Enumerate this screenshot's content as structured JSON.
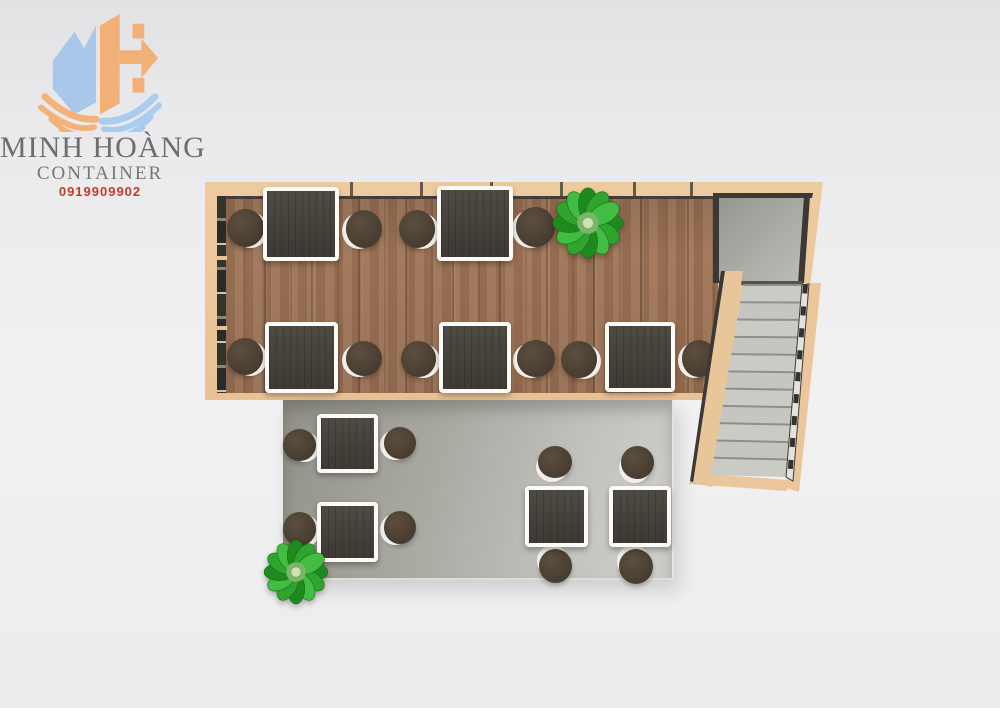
{
  "brand": {
    "name": "MINH HOÀNG",
    "subtitle": "CONTAINER",
    "phone": "0919909902",
    "colors": {
      "m_blue": "#a9c7e8",
      "h_orange": "#f2b077",
      "wing_orange": "#f3b277",
      "wing_blue": "#a9cdec",
      "text_gray": "#6e6e6e",
      "phone_red": "#c23a2c"
    }
  },
  "scene": {
    "description": "Top-down 3D floor plan of a container cafe: upper wood-floor container room with tables and stools, exterior concrete deck with tables, side staircase with landing, two green plants",
    "upper_room": {
      "floor": "wood",
      "tables": 5,
      "stools": 10,
      "plants": 1
    },
    "lower_deck": {
      "floor": "concrete",
      "tables": 4,
      "stools": 8,
      "plants": 1
    },
    "staircase": {
      "steps": 11,
      "has_landing": true
    }
  },
  "palette": {
    "wall_tan": "#ebc69b",
    "wood": "#9e7355",
    "frame_dark": "#3b3835",
    "landing_a": "#94978f",
    "landing_b": "#bcbfb7",
    "step": "#cbcbc6",
    "step_line": "#8f8f8a",
    "deck": "#a9a9a2",
    "table_top": "#45403a",
    "table_border": "#fbfaf7",
    "stool": "#4a3f32",
    "plant_greens": [
      "#1e8a1e",
      "#2fa42f",
      "#43bc43"
    ],
    "plant_center": "#7ab569"
  },
  "layout": {
    "wall_ticks_x": [
      350,
      420,
      490,
      560,
      633,
      690
    ],
    "wall_breaks_y": [
      256,
      326
    ],
    "tables": [
      [
        263,
        187,
        76,
        74
      ],
      [
        437,
        186,
        76,
        75
      ],
      [
        265,
        322,
        73,
        71
      ],
      [
        439,
        322,
        72,
        71
      ],
      [
        605,
        322,
        70,
        70
      ],
      [
        317,
        414,
        61,
        59
      ],
      [
        317,
        502,
        61,
        60
      ],
      [
        525,
        486,
        63,
        61
      ],
      [
        609,
        486,
        62,
        61
      ]
    ],
    "stools": [
      [
        227,
        209,
        37,
        38,
        5,
        2
      ],
      [
        346,
        210,
        36,
        38,
        -5,
        2
      ],
      [
        399,
        210,
        36,
        38,
        5,
        2
      ],
      [
        516,
        207,
        39,
        40,
        -5,
        2
      ],
      [
        227,
        338,
        36,
        37,
        5,
        2
      ],
      [
        346,
        341,
        36,
        35,
        -5,
        2
      ],
      [
        401,
        341,
        35,
        36,
        5,
        2
      ],
      [
        517,
        340,
        38,
        37,
        -5,
        2
      ],
      [
        561,
        341,
        36,
        37,
        5,
        2
      ],
      [
        682,
        340,
        34,
        37,
        -5,
        2
      ],
      [
        283,
        429,
        33,
        32,
        5,
        2
      ],
      [
        384,
        427,
        32,
        32,
        -5,
        2
      ],
      [
        283,
        512,
        33,
        34,
        5,
        2
      ],
      [
        384,
        511,
        32,
        33,
        -5,
        2
      ],
      [
        538,
        446,
        34,
        32,
        -3,
        5
      ],
      [
        621,
        446,
        33,
        33,
        -3,
        5
      ],
      [
        539,
        549,
        33,
        34,
        -3,
        -5
      ],
      [
        619,
        549,
        34,
        35,
        -3,
        -5
      ]
    ],
    "plants": [
      {
        "cx": 588,
        "cy": 223,
        "r": 32
      },
      {
        "cx": 296,
        "cy": 572,
        "r": 29
      }
    ],
    "stairs": {
      "svg_box": [
        655,
        178,
        180,
        325
      ],
      "right_stringer": [
        [
          808,
          283
        ],
        [
          821,
          283
        ],
        [
          799,
          492
        ],
        [
          786,
          488
        ]
      ],
      "bottom_strip": [
        [
          692,
          473
        ],
        [
          789,
          480
        ],
        [
          787,
          491
        ],
        [
          689,
          484
        ]
      ],
      "landing": [
        [
          718,
          196
        ],
        [
          809,
          196
        ],
        [
          803,
          283
        ],
        [
          718,
          283
        ]
      ],
      "landing_top_frame": [
        [
          713,
          193
        ],
        [
          813,
          193
        ],
        [
          812,
          198
        ],
        [
          713,
          198
        ]
      ],
      "landing_left_frame": [
        [
          713,
          196
        ],
        [
          719,
          196
        ],
        [
          719,
          283
        ],
        [
          713,
          283
        ]
      ],
      "landing_right_frame": [
        [
          804,
          196
        ],
        [
          810,
          196
        ],
        [
          804,
          283
        ],
        [
          798,
          283
        ]
      ],
      "landing_bottom_line": [
        [
          719,
          281
        ],
        [
          803,
          281
        ],
        [
          803,
          285
        ],
        [
          719,
          285
        ]
      ],
      "railing": [
        [
          725,
          271
        ],
        [
          743,
          271
        ],
        [
          712,
          487
        ],
        [
          693,
          483
        ]
      ],
      "railing_edge": [
        [
          721,
          271
        ],
        [
          727,
          271
        ],
        [
          696,
          484
        ],
        [
          690,
          481
        ]
      ],
      "steps_quad": {
        "tl": [
          743,
          285
        ],
        "tr": [
          802,
          285
        ],
        "br": [
          786,
          477
        ],
        "bl": [
          711,
          475
        ]
      },
      "n_steps": 11,
      "right_rail": [
        [
          802,
          285
        ],
        [
          809,
          284
        ],
        [
          793,
          481
        ],
        [
          786,
          477
        ]
      ]
    }
  }
}
